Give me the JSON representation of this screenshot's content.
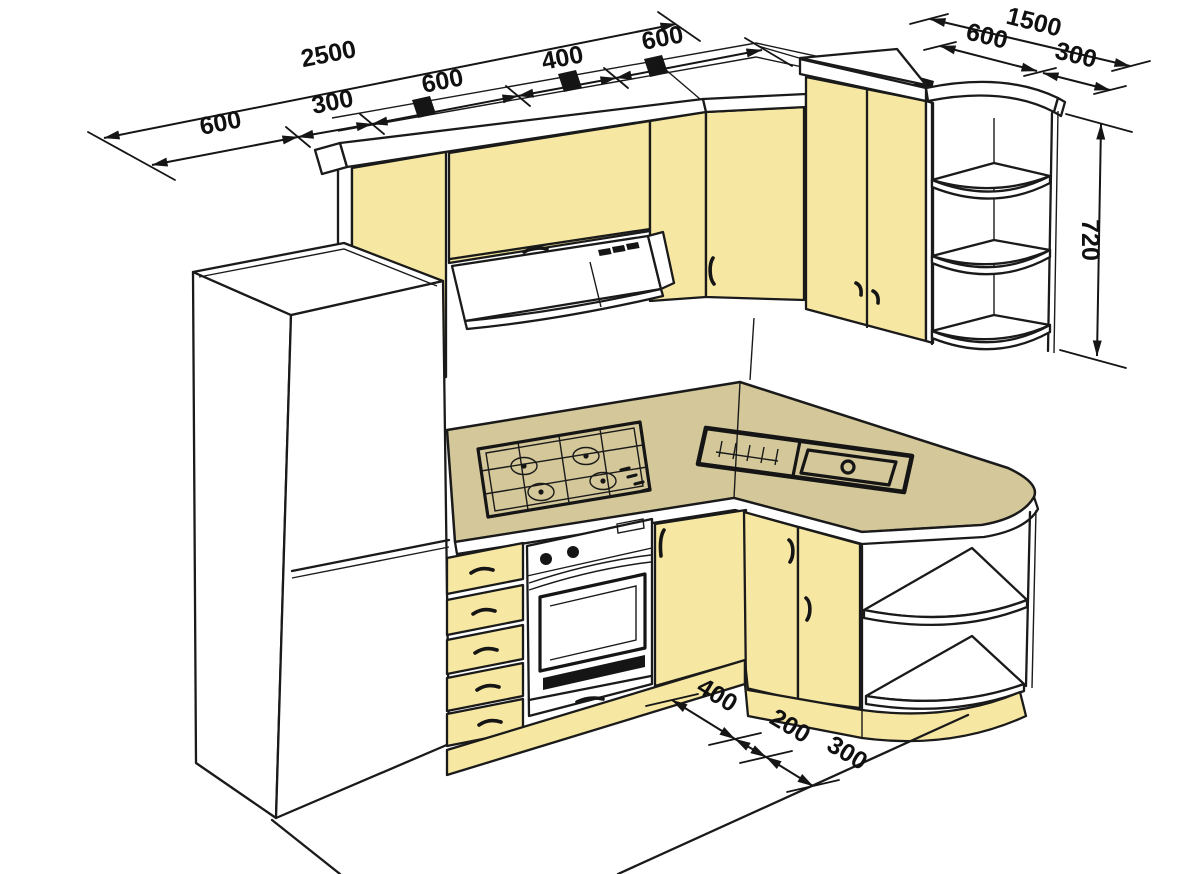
{
  "dimensions": {
    "left_run": {
      "total": "2500",
      "segments": [
        "600",
        "300",
        "600",
        "400",
        "600"
      ]
    },
    "right_run": {
      "total": "1500",
      "segments": [
        "600",
        "300"
      ]
    },
    "corner_unit_height": "720",
    "floor_run": {
      "segments": [
        "400",
        "200",
        "300"
      ]
    }
  },
  "colors": {
    "cabinet_front": "#F6E7A2",
    "countertop": "#D4C89A",
    "outline": "#1A1A1A",
    "background": "#FFFFFF"
  }
}
